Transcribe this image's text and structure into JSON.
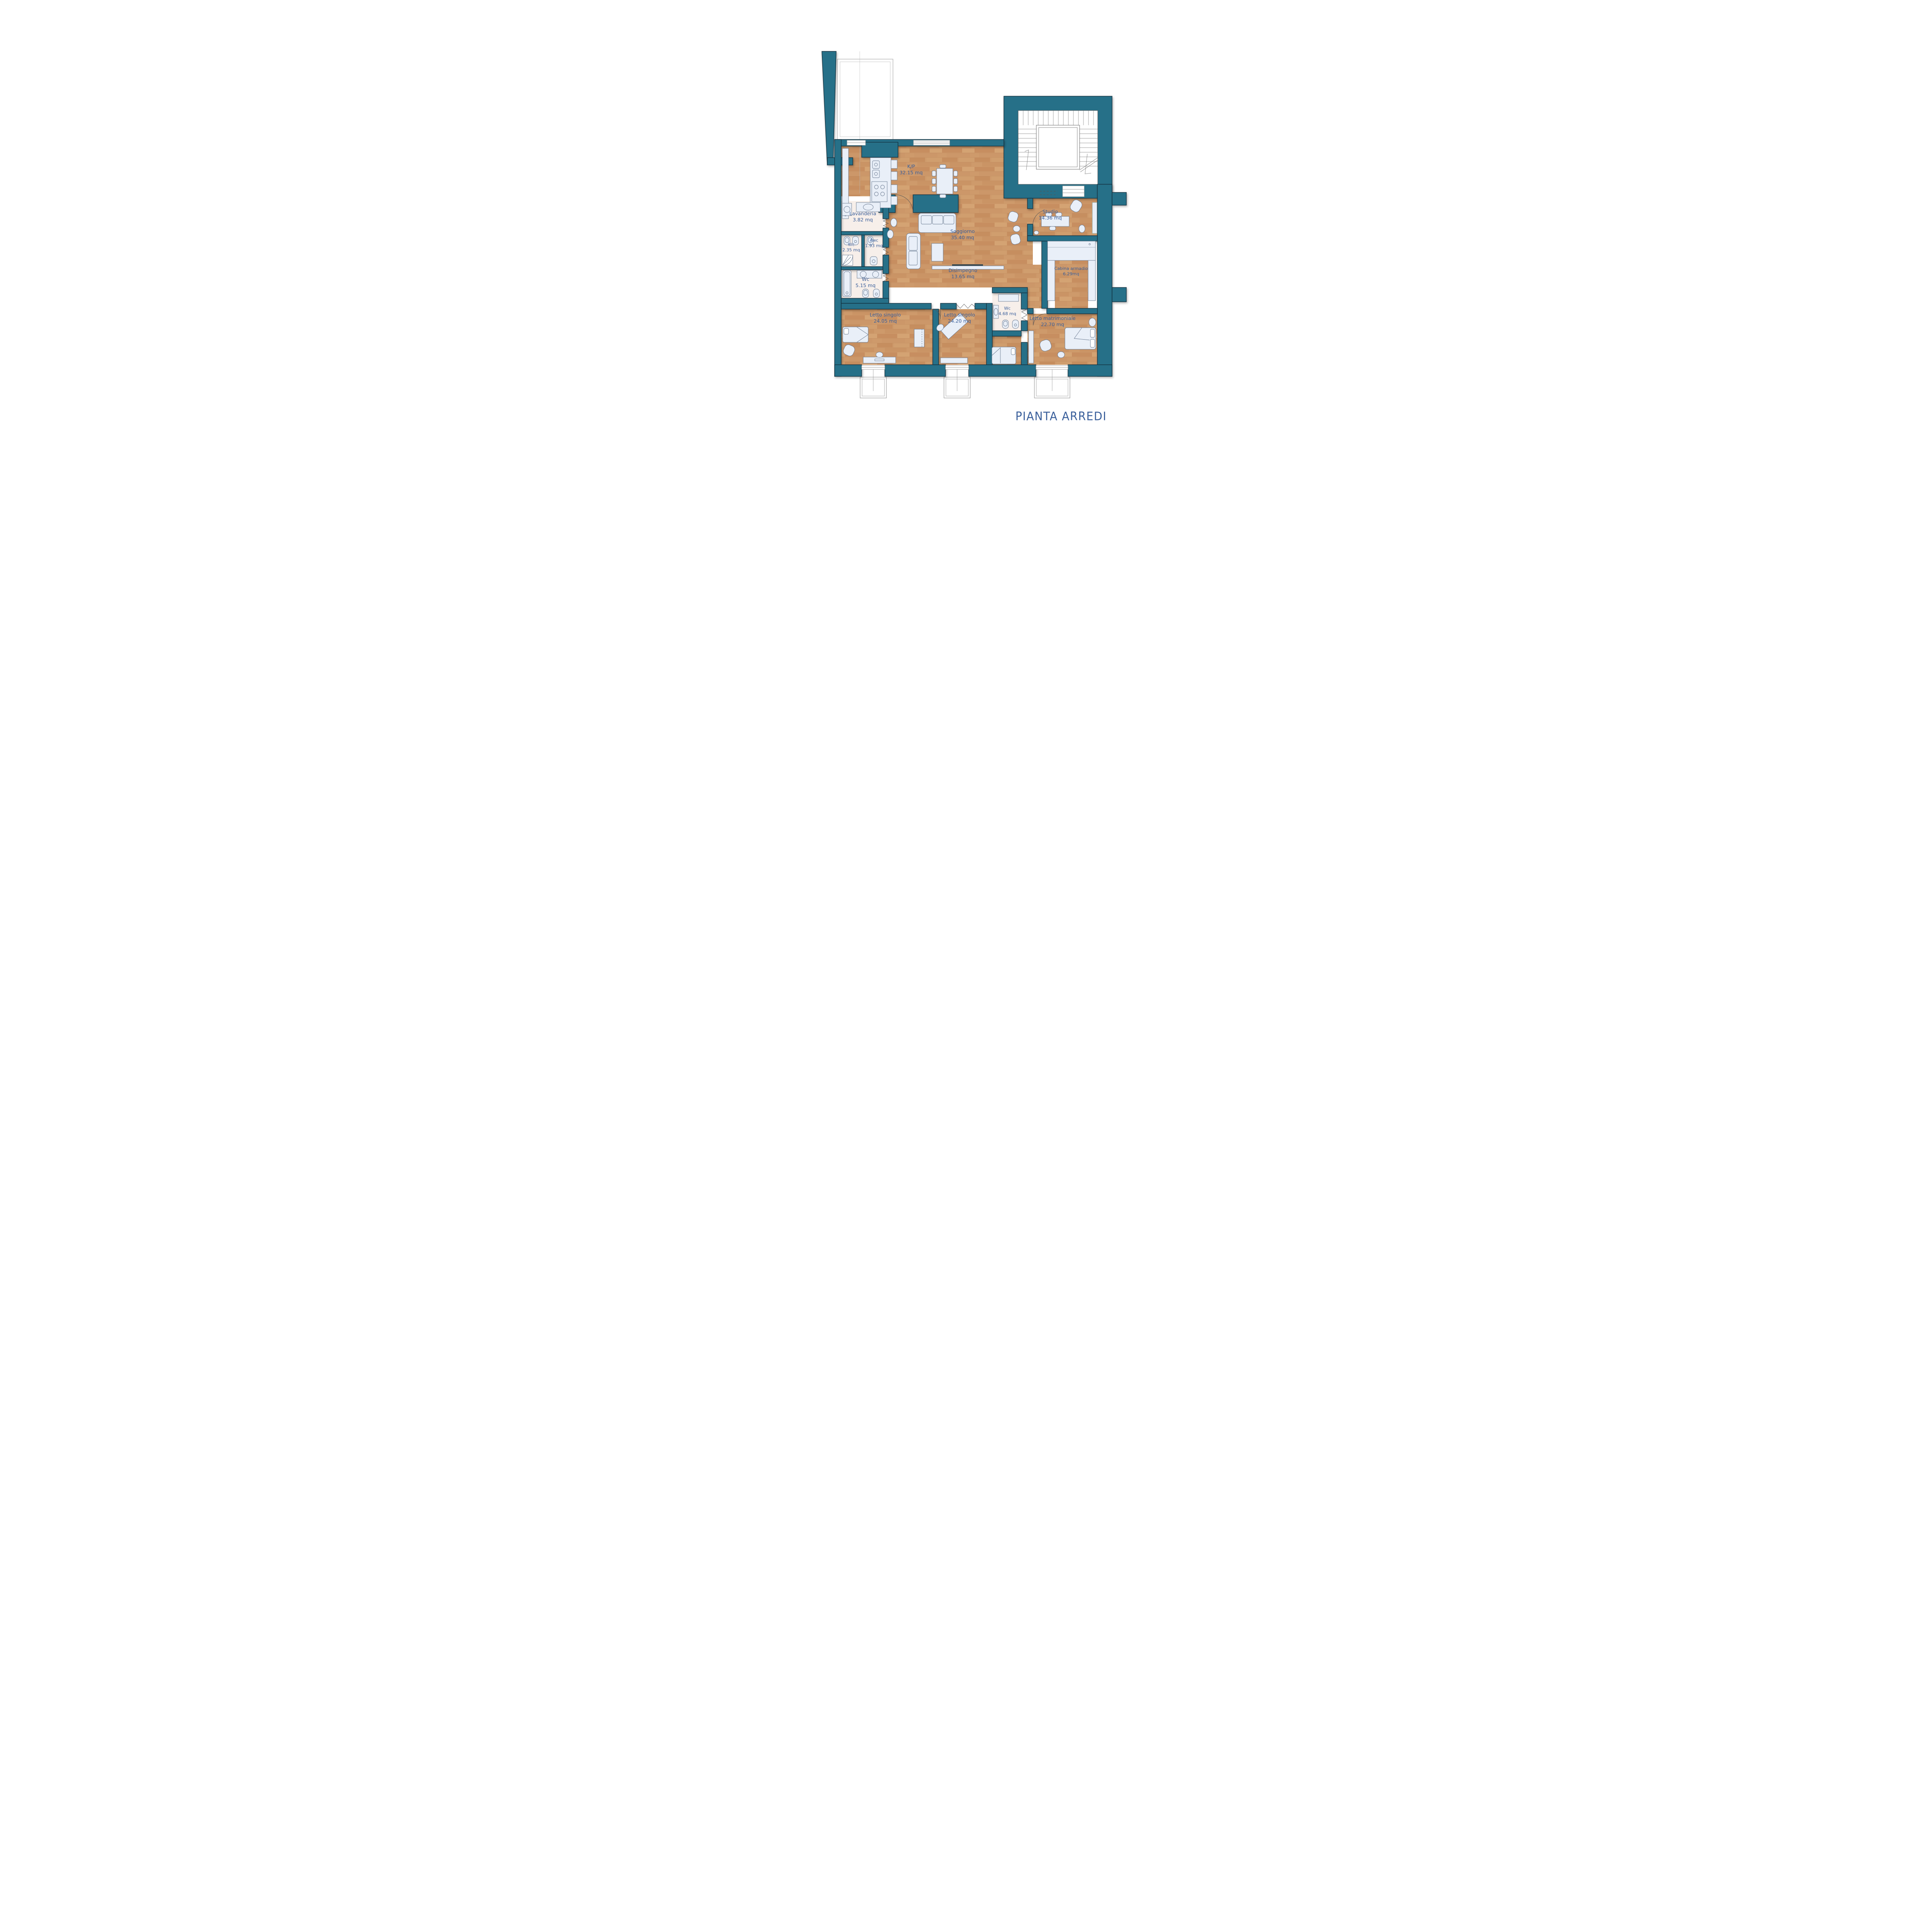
{
  "title": "PIANTA ARREDI",
  "rooms": [
    {
      "id": "kp",
      "name": "K/P",
      "area": "32.15 mq"
    },
    {
      "id": "lavanderia",
      "name": "Lavanderia",
      "area": "3.82 mq"
    },
    {
      "id": "wc-piccolo",
      "name": "Wc",
      "area": "2.35 mq"
    },
    {
      "id": "awc",
      "name": "Awc",
      "area": "1.93 mq"
    },
    {
      "id": "wc-medio",
      "name": "Wc",
      "area": "5.15 mq"
    },
    {
      "id": "soggiorno",
      "name": "Soggiorno",
      "area": "35.40 mq"
    },
    {
      "id": "studio",
      "name": "Studio",
      "area": "14.36 mq"
    },
    {
      "id": "disimpegno",
      "name": "Disimpegno",
      "area": "13.65 mq"
    },
    {
      "id": "cabina-armadio",
      "name": "Cabina armadio",
      "area": "6.29mq"
    },
    {
      "id": "letto-singolo-1",
      "name": "Letto singolo",
      "area": "24.05 mq"
    },
    {
      "id": "letto-singolo-2",
      "name": "Letto singolo",
      "area": "24.20 mq"
    },
    {
      "id": "wc-camere",
      "name": "Wc",
      "area": "4.68 mq"
    },
    {
      "id": "letto-matrimoniale",
      "name": "Letto matrimoniale",
      "area": "22.70 mq"
    }
  ],
  "colors": {
    "wall": "#256F88",
    "wood_floor": "#CE9A6B",
    "bath_floor": "#F7EFEA",
    "furniture": "#E9EFF8",
    "room_label": "#3A5F9B",
    "title": "#3A5F9B"
  }
}
